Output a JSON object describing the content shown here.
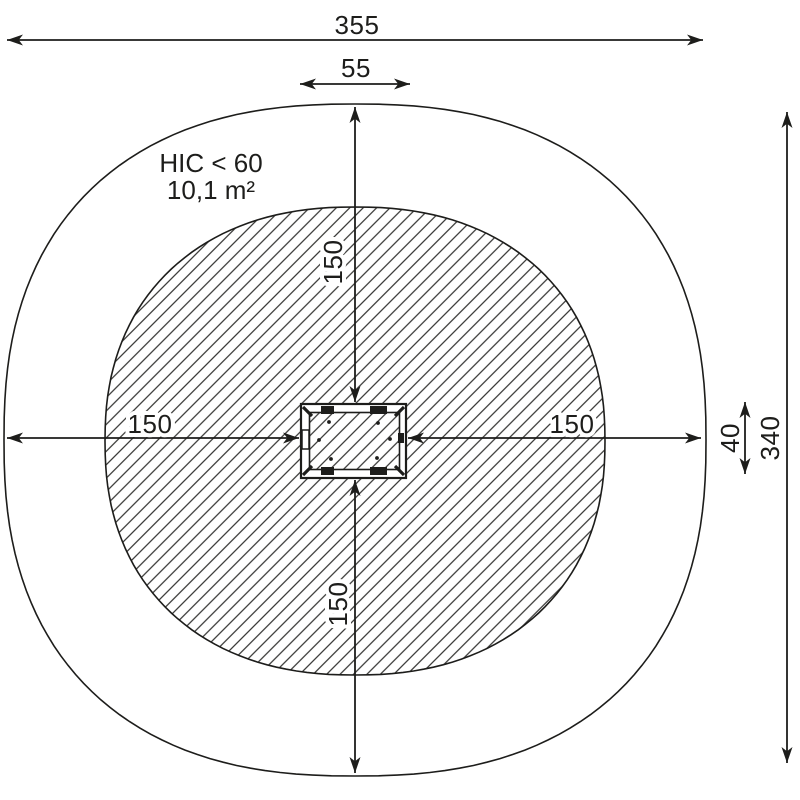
{
  "diagram": {
    "kind": "playground-equipment-safety-zone-plan",
    "annotations": {
      "hic": "HIC < 60",
      "area": "10,1 m²"
    },
    "dimensions": {
      "total_width": "355",
      "equipment_width": "55",
      "clearance_top": "150",
      "clearance_left": "150",
      "clearance_right": "150",
      "clearance_bottom": "150",
      "equipment_height": "40",
      "total_height": "340"
    },
    "colors": {
      "line": "#1d1d1b",
      "background": "#ffffff",
      "hatch": "#1d1d1b"
    }
  }
}
